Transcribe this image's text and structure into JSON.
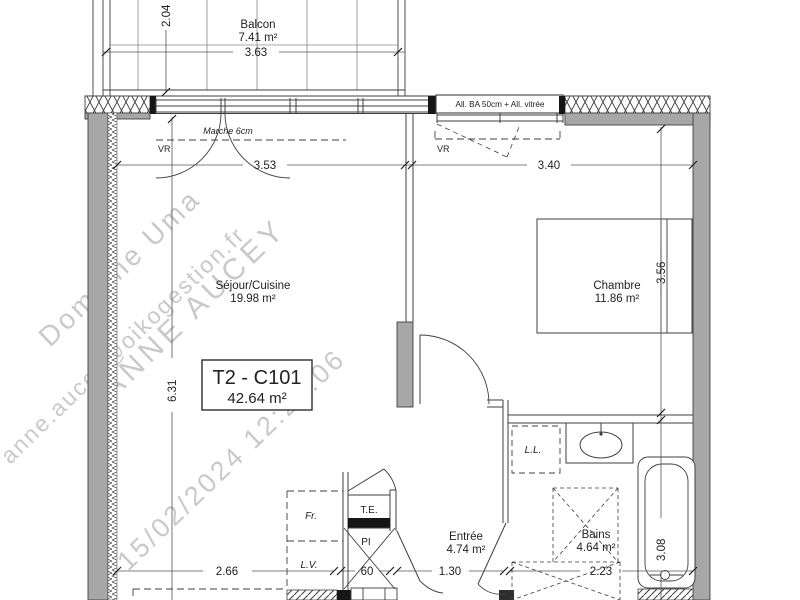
{
  "unit": {
    "code": "T2 - C101",
    "area": "42.64 m²"
  },
  "rooms": [
    {
      "name": "Balcon",
      "area": "7.41 m²"
    },
    {
      "name": "Séjour/Cuisine",
      "area": "19.98 m²"
    },
    {
      "name": "Chambre",
      "area": "11.86 m²"
    },
    {
      "name": "Entrée",
      "area": "4.74 m²"
    },
    {
      "name": "Bains",
      "area": "4.64 m²"
    }
  ],
  "dimensions": {
    "balcony_width": "3.63",
    "balcony_depth": "2.04",
    "sejour_width": "3.53",
    "chambre_width": "3.40",
    "chambre_depth": "3.56",
    "sejour_depth": "6.31",
    "bains_depth": "3.08",
    "kitchen_width": "2.66",
    "closet_width": "60",
    "entree_width": "1.30",
    "bains_width": "2.23"
  },
  "annotations": {
    "step": "Marche 6cm",
    "allege": "All. BA 50cm + All. vitrée",
    "shutter": "VR",
    "washer": "L.L.",
    "fridge": "Fr.",
    "dishwasher": "L.V.",
    "electrical": "T.E.",
    "closet": "PI"
  },
  "watermark": [
    "Domaine Uma",
    "anne.aucey@oikogestion.fr",
    "ANNE AUCEY",
    "15/02/2024 12:27:06"
  ],
  "colors": {
    "wall_fill": "#a7a7a7",
    "line": "#3f3f3f",
    "watermark": "#c9c9c9",
    "background": "#ffffff"
  }
}
